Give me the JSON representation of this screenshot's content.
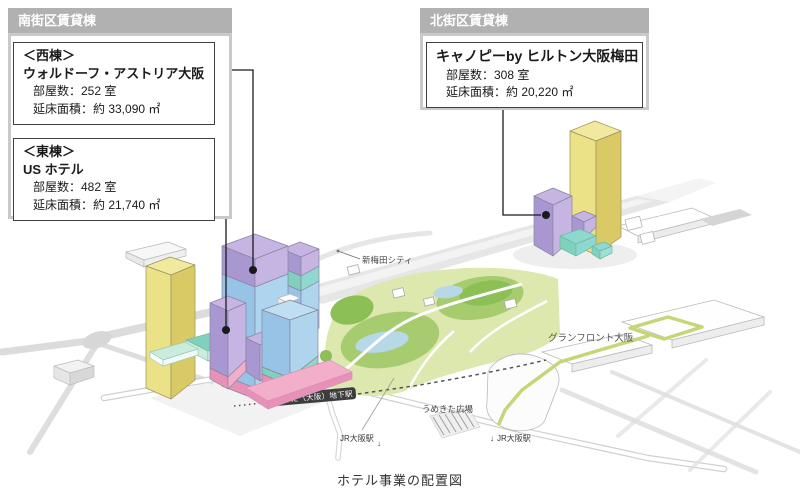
{
  "page": {
    "caption": "ホテル事業の配置図"
  },
  "colors": {
    "header_bg": "#b1b1b1",
    "border_outer": "#c9c9c9",
    "border_inner": "#3f3f3f",
    "connector": "#1a1a1a",
    "yellow_light": "#ebe187",
    "yellow_dark": "#d9ca66",
    "purple_light": "#c6b5e2",
    "purple_mid": "#a897d1",
    "blue_light": "#aed4ee",
    "blue_mid": "#97c4e6",
    "pink_light": "#f3afca",
    "pink_mid": "#e891b8",
    "teal": "#7fd0bd",
    "mint": "#c9ecdd",
    "park_light": "#dce8ad",
    "park_mid": "#a7cc6f",
    "park_dark": "#8cbf55",
    "pond": "#b6d8e7",
    "road": "#d6d6d6",
    "station_bar": "#3d3d3d",
    "path_green": "#c5d678",
    "outline": "#b9b9b9"
  },
  "callouts": {
    "south": {
      "header": "南街区賃貸棟",
      "west": {
        "tag": "＜西棟＞",
        "name": "ウォルドーフ・アストリア大阪",
        "rooms": "部屋数：252 室",
        "area": "延床面積：約 33,090 ㎡"
      },
      "east": {
        "tag": "＜東棟＞",
        "name": "US ホテル",
        "rooms": "部屋数：482 室",
        "area": "延床面積：約 21,740 ㎡"
      }
    },
    "north": {
      "header": "北街区賃貸棟",
      "hotel": {
        "name": "キャノピーby ヒルトン大阪梅田",
        "rooms": "部屋数：308 室",
        "area": "延床面積：約 20,220 ㎡"
      }
    }
  },
  "labels": {
    "shin_umeda": "新梅田シティ",
    "grand_front": "グランフロント大阪",
    "station_bar": "うめきた（大阪）地下駅",
    "plaza": "うめきた広場",
    "jr_west": "JR大阪駅",
    "jr_east": "JR大阪駅",
    "down_arrow": "↓"
  }
}
